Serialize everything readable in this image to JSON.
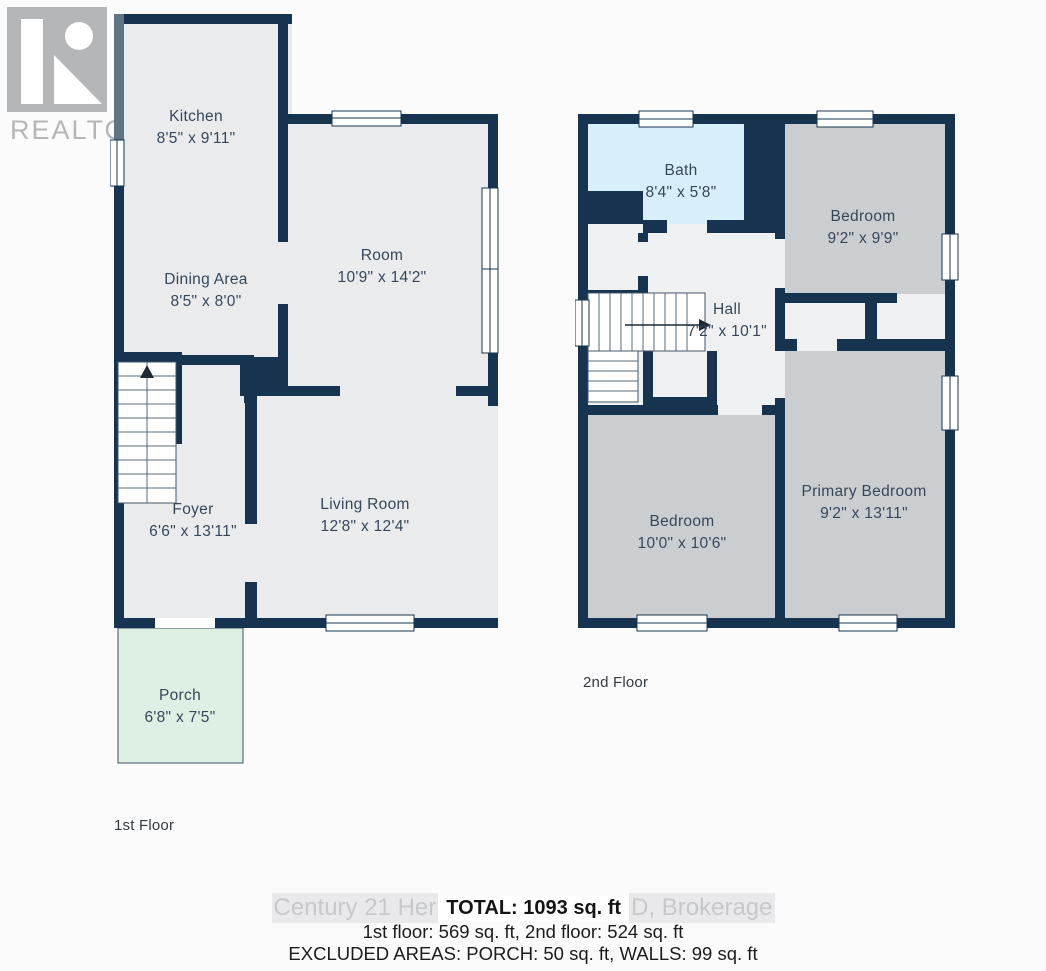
{
  "logo": {
    "letter": "R",
    "brand": "REALTOR",
    "registered_mark": "®"
  },
  "floor1": {
    "caption": "1st Floor",
    "rooms": [
      {
        "name": "Kitchen",
        "dims": "8'5\" x 9'11\""
      },
      {
        "name": "Dining Area",
        "dims": "8'5\" x 8'0\""
      },
      {
        "name": "Room",
        "dims": "10'9\" x 14'2\""
      },
      {
        "name": "Foyer",
        "dims": "6'6\" x 13'11\""
      },
      {
        "name": "Living Room",
        "dims": "12'8\" x 12'4\""
      },
      {
        "name": "Porch",
        "dims": "6'8\" x 7'5\""
      }
    ]
  },
  "floor2": {
    "caption": "2nd Floor",
    "rooms": [
      {
        "name": "Bath",
        "dims": "8'4\" x 5'8\""
      },
      {
        "name": "Bedroom",
        "dims": "9'2\" x 9'9\""
      },
      {
        "name": "Hall",
        "dims": "7'2\" x 10'1\""
      },
      {
        "name": "Bedroom",
        "dims": "10'0\" x 10'6\""
      },
      {
        "name": "Primary Bedroom",
        "dims": "9'2\" x 13'11\""
      }
    ]
  },
  "footer": {
    "watermark_left": "Century 21 Her",
    "watermark_right": "D, Brokerage",
    "total": "TOTAL: 1093 sq. ft",
    "floors_line": "1st floor: 569 sq. ft, 2nd floor: 524 sq. ft",
    "excluded_line": "EXCLUDED AREAS: PORCH: 50 sq. ft, WALLS: 99 sq. ft"
  },
  "colors": {
    "wall": "#16344f",
    "wall_faded": "#5e7584",
    "room": "#e9ebed",
    "hall": "#eef0f2",
    "bedroom": "#cbced1",
    "bath": "#d8effb",
    "porch": "#def0e4"
  }
}
